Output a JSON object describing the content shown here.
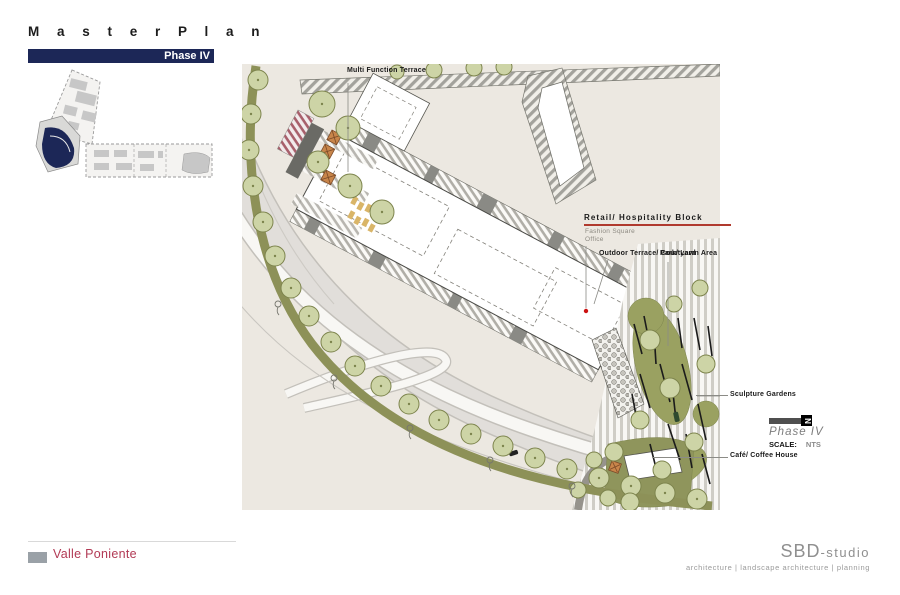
{
  "header": {
    "title": "M a s t e r   P l a n",
    "title_plain": "Master Plan",
    "phase_badge": "Phase IV"
  },
  "plan_labels": {
    "multi_function_terrace": "Multi Function Terrace",
    "retail_hospitality": "Retail/ Hospitality Block",
    "fashion_square": "Fashion Square",
    "office": "Office",
    "outdoor_terrace": "Outdoor Terrace/ Courtyard",
    "park_lawn": "Park/ Lawn Area",
    "sculpture_gardens": "Sculpture Gardens",
    "cafe": "Café/ Coffee House"
  },
  "legend": {
    "phase": "Phase IV",
    "scale_label": "SCALE:",
    "scale_value": "NTS",
    "north_letter": "N"
  },
  "footer": {
    "project": "Valle Poniente",
    "studio_name": "SBD",
    "studio_suffix": "-studio",
    "tagline": "architecture | landscape architecture |  planning"
  },
  "colors": {
    "navy": "#1c2757",
    "crimson": "#b23a55",
    "underline_red": "#b03a2e",
    "olive_band": "#8d9158",
    "tree_fill": "#cdd4a6",
    "lawn": "#9aa161",
    "beige": "#ece8e1",
    "umbrella_orange": "#c8854a",
    "red_dot": "#cc1111",
    "studio_gray": "#8f8f8f"
  }
}
